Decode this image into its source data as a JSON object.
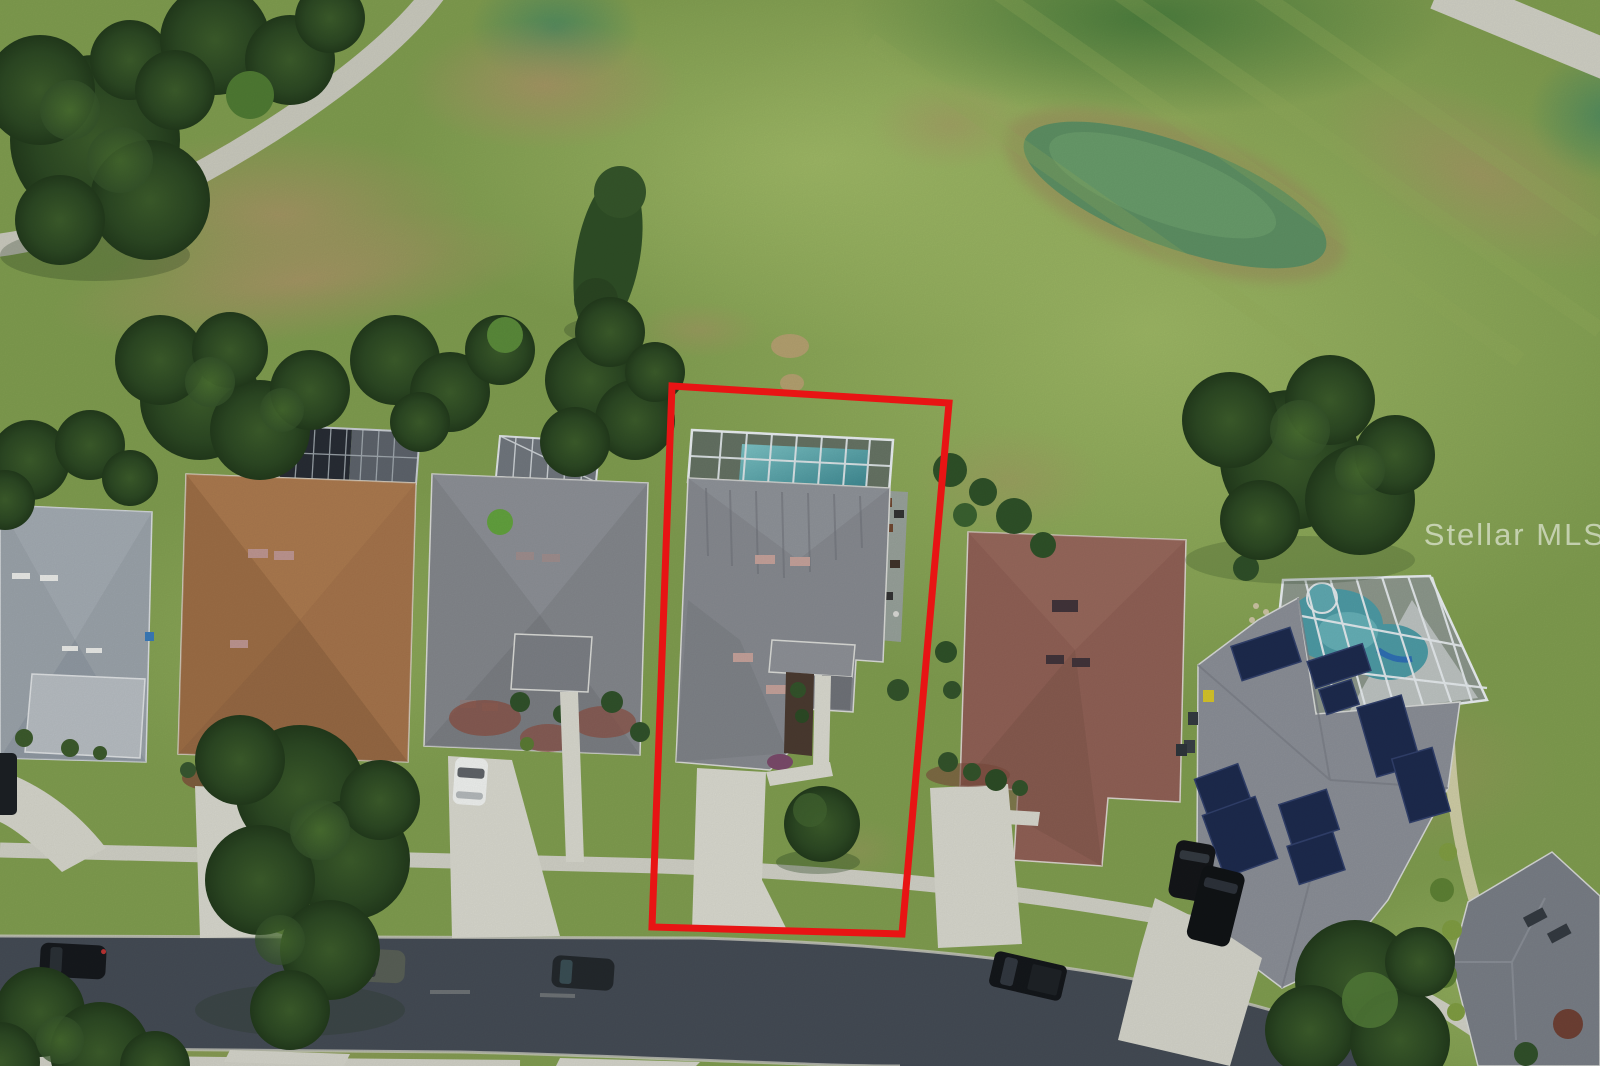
{
  "photo": {
    "watermark_text": "Stellar MLS",
    "description": "Aerial drone photo of a residential street bordering a golf course; the subject lot with a screened pool enclosure is outlined in red"
  },
  "annotation": {
    "boundary_color": "#e81414",
    "boundary_width": 7
  },
  "scene": {
    "houses_visible": 7,
    "street_parked_cars": 4,
    "driveway_vehicles": 4,
    "pool_enclosures": 3,
    "golf_features": [
      "cart-path",
      "fairway",
      "putting-green",
      "rough"
    ]
  },
  "palette": {
    "grass_base": "#7f9c4f",
    "fairway_light": "#9cb765",
    "green_dark": "#46793b",
    "rough_brown": "#a79365",
    "tree_dark": "#2c4823",
    "tree_light": "#47692f",
    "asphalt": "#444b54",
    "concrete": "#d7d7cd",
    "sidewalk": "#cfcfc5",
    "roof_subject": "#86898f",
    "roof_left_gray": "#9aa2a9",
    "roof_brown": "#a0714a",
    "roof_mid_gray": "#83868b",
    "roof_mauve": "#8f6055",
    "roof_solar_house": "#8a8e96",
    "solar_panel": "#1d2a4d",
    "pool_teal": "#4d9aa4",
    "cage_frame": "#e8edf0",
    "watermark_color": "rgba(255,255,255,0.55)"
  }
}
